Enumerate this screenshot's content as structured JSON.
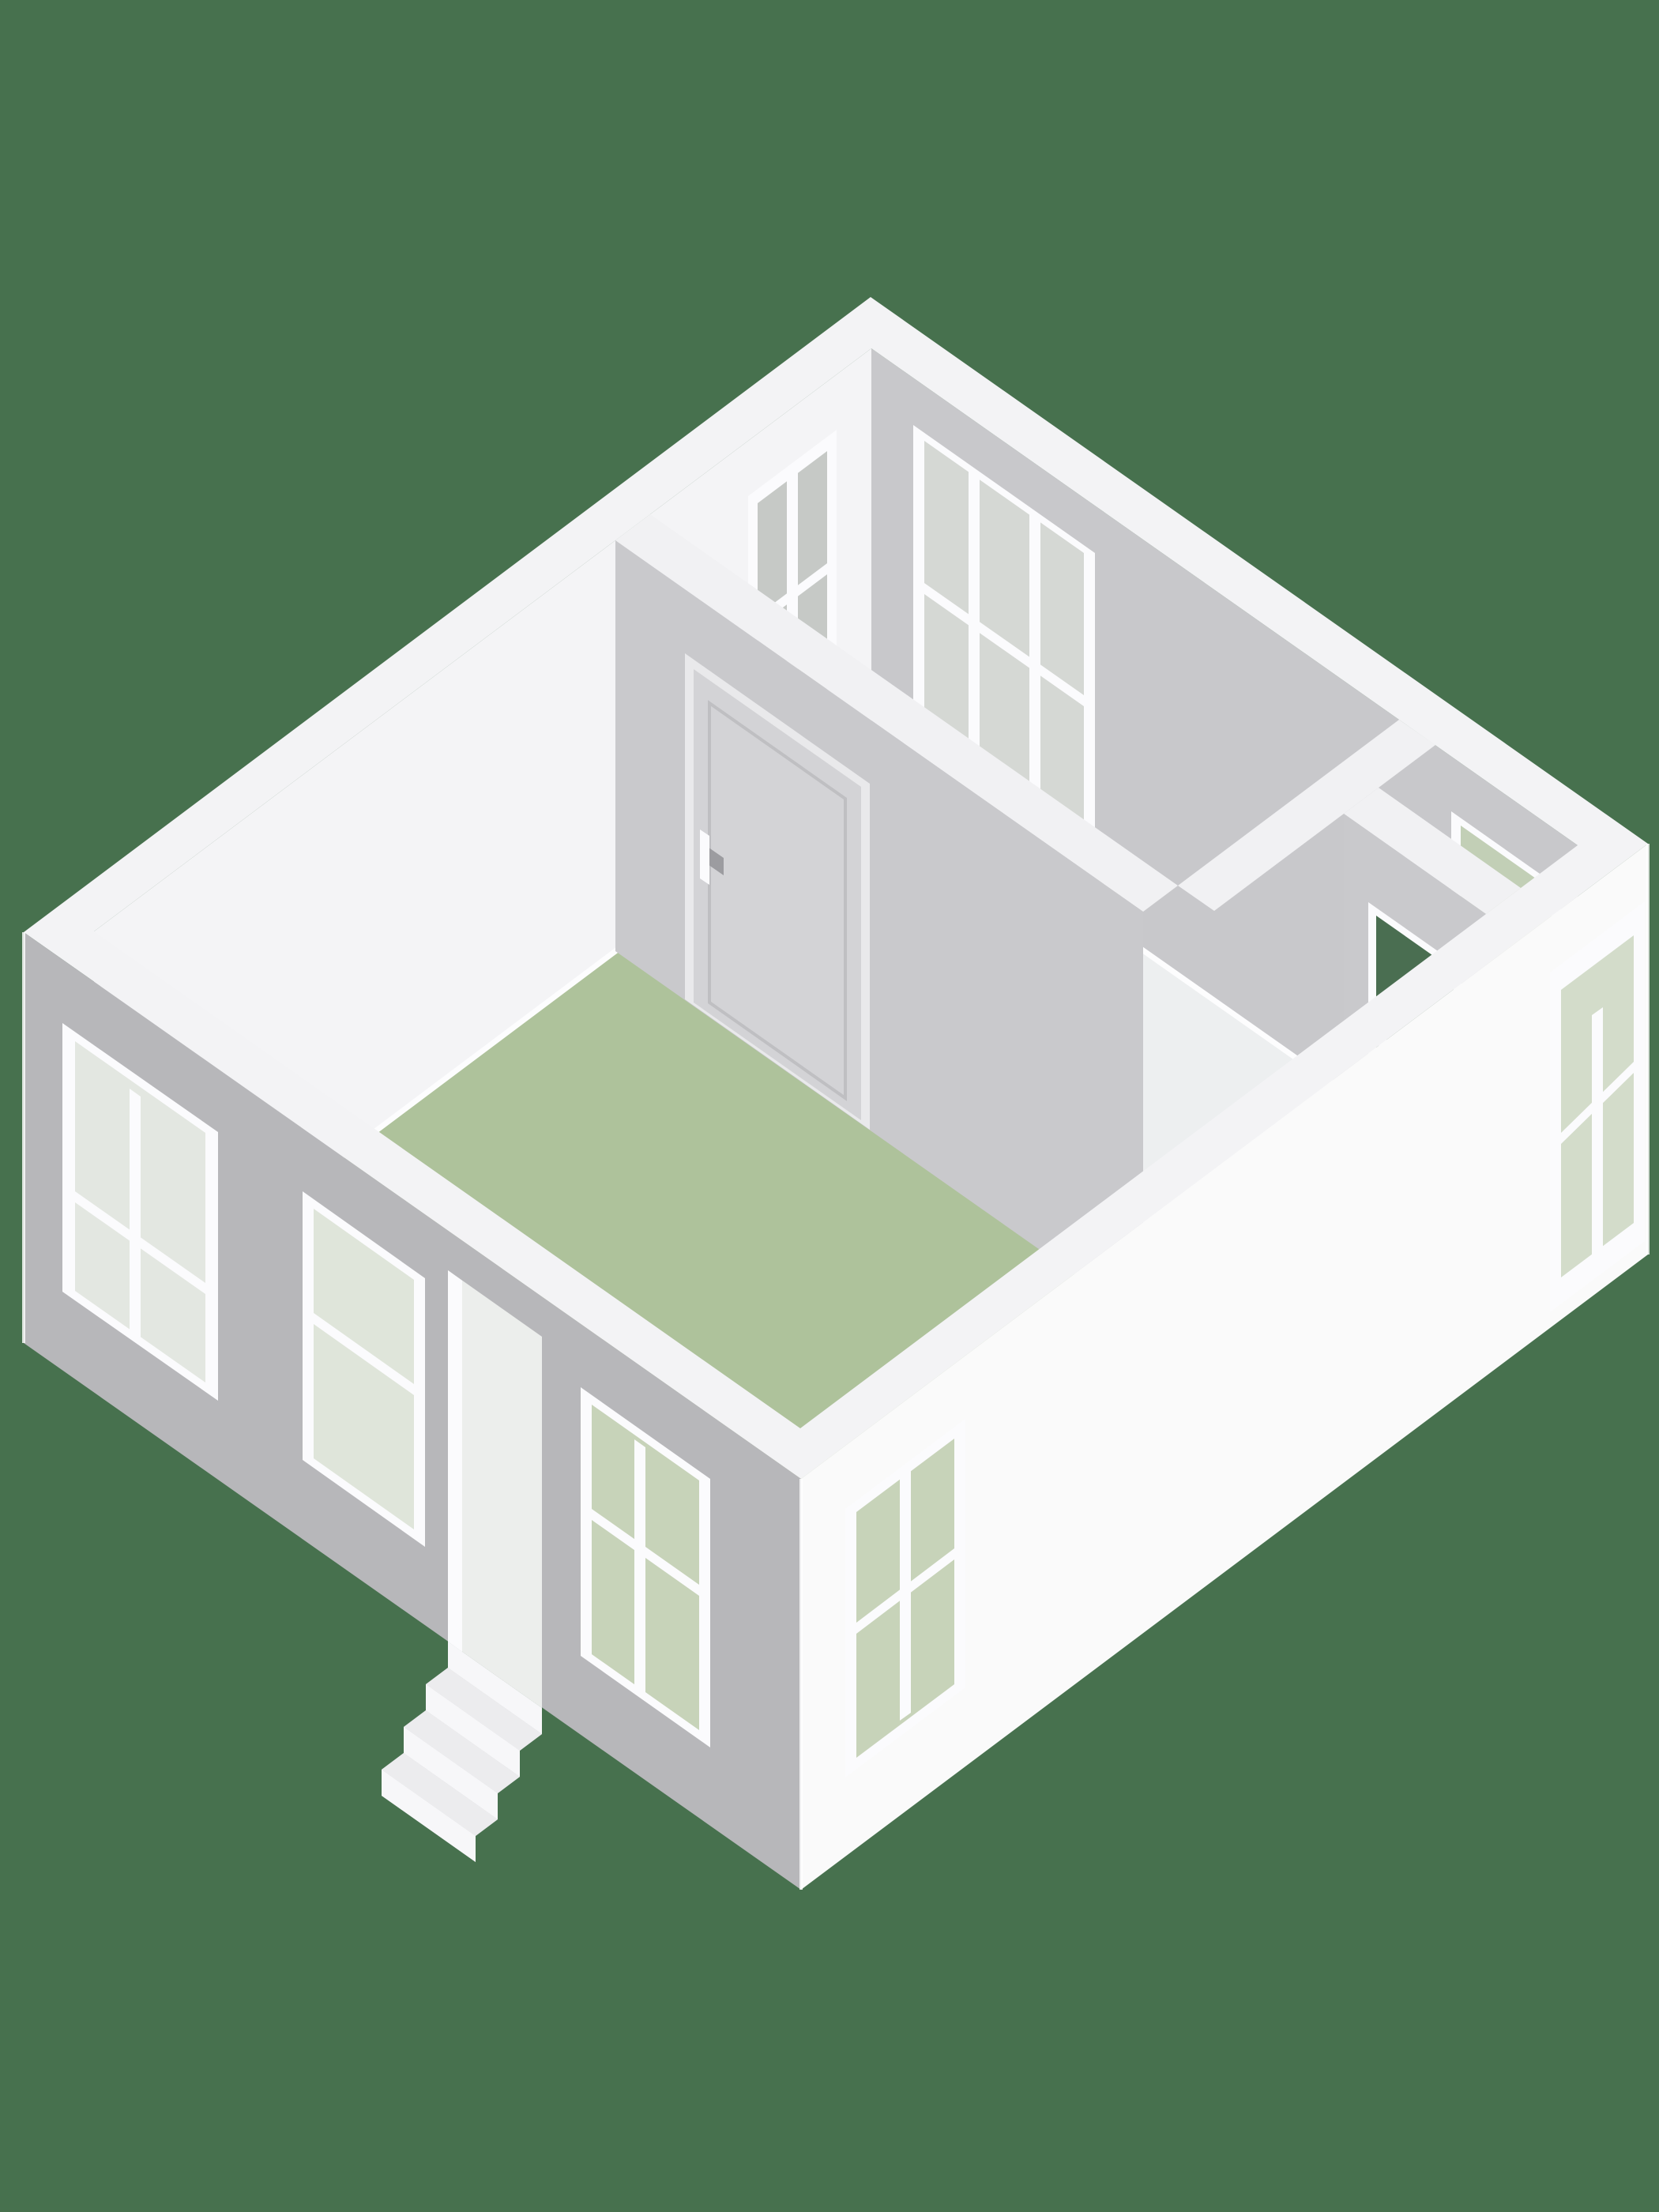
{
  "meta": {
    "view": "isometric-3d-floorplan",
    "description": "3D floor plan render of a single-storey dwelling, viewed from above at an angle",
    "rooms": [
      {
        "name": "main-room",
        "floor": "green"
      },
      {
        "name": "north-room",
        "floor": "white"
      },
      {
        "name": "east-room",
        "floor": "light"
      }
    ],
    "window_count": 9,
    "interior_door_count": 1,
    "exterior_stair_steps": 4
  },
  "colors": {
    "background": "#47714e",
    "floorMain": "#aec29b",
    "floorNorthRoom": "#edeff0",
    "floorEastRoom": "#e8eae9",
    "wallTop": "#f3f3f5",
    "wallInnerWhite": "#f4f4f6",
    "wallInnerGray": "#c8c8cb",
    "wallOuterSW": "#b7b7ba",
    "wallOuterSE": "#fafafa",
    "partition": "#c9c9cc",
    "partitionTop": "#f1f1f3",
    "frame": "#fbfbfd",
    "glassInterior": "#d5d8d4",
    "glassGray": "#c6c9c6",
    "glassGreenLight": "#c7d3b9",
    "glassGreenMid": "#c2cfb6",
    "glassGreenSoft": "#d3dcca",
    "glassDark": "#4a6e51",
    "glassPale": "#e3e7e1",
    "glassPale2": "#dfe5da",
    "doorLeaf": "#d3d3d6",
    "doorFrame": "#e9e9eb",
    "handle": "#9c9ca0",
    "baseboard": "#fdfdfe",
    "stairTread": "#ececee",
    "stairRiser": "#f7f7f9",
    "stairSide": "#d2d2d5",
    "openingInterior": "#eceeec",
    "edge": "#ffffff"
  }
}
